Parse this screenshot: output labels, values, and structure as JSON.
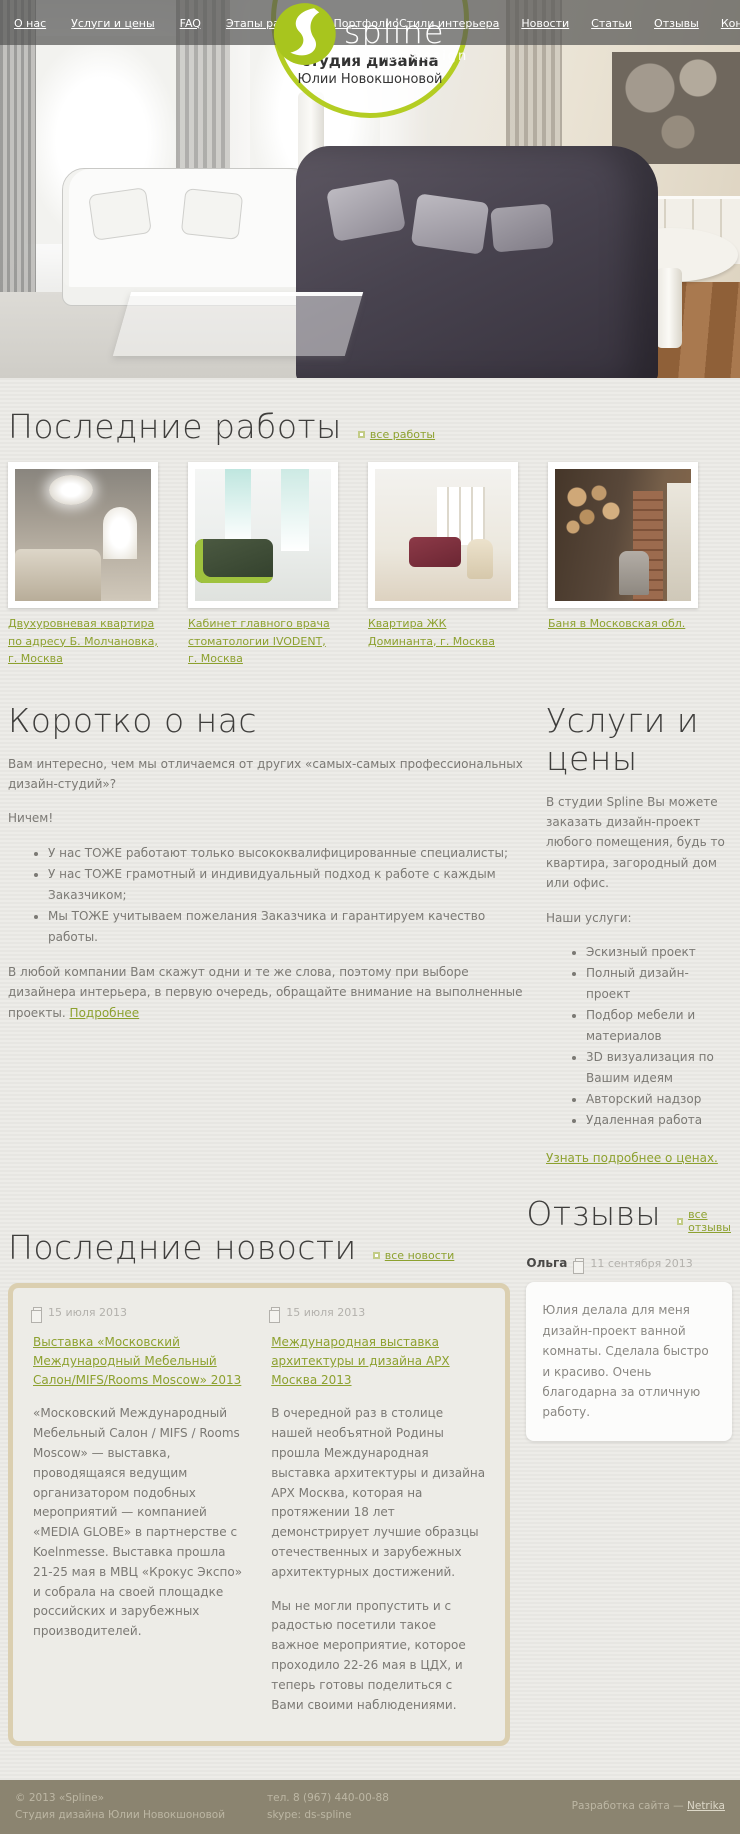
{
  "header": {
    "nav_left": [
      "О нас",
      "Услуги и цены",
      "FAQ",
      "Этапы работы",
      "Портфолио"
    ],
    "nav_right": [
      "Стили интерьера",
      "Новости",
      "Статьи",
      "Отзывы",
      "Контакты"
    ],
    "logo": {
      "name": "spline",
      "tagline": "interior design",
      "green": "#a8c51e"
    },
    "badge": {
      "line1": "студия дизайна",
      "line2": "Юлии Новокшоновой"
    }
  },
  "works": {
    "title": "Последние работы",
    "all_link": "все работы",
    "items": [
      {
        "title": "Двухуровневая квартира по адресу Б. Молчановка, г. Москва"
      },
      {
        "title": "Кабинет главного врача стоматологии IVODENT, г. Москва"
      },
      {
        "title": "Квартира ЖК Доминанта, г. Москва"
      },
      {
        "title": "Баня в Московская обл."
      }
    ]
  },
  "about": {
    "title": "Коротко о нас",
    "intro": "Вам интересно, чем мы отличаемся от других «самых-самых профессиональных дизайн-студий»?",
    "nothing": "Ничем!",
    "bullets": [
      "У нас ТОЖЕ работают только высококвалифицированные специалисты;",
      "У нас ТОЖЕ грамотный и индивидуальный подход к работе с каждым Заказчиком;",
      "Мы ТОЖЕ учитываем пожелания Заказчика и гарантируем качество работы."
    ],
    "outro": "В любой компании Вам скажут одни и те же слова, поэтому при выборе дизайнера интерьера, в первую очередь, обращайте внимание на выполненные проекты.",
    "more_link": "Подробнее"
  },
  "services": {
    "title": "Услуги и цены",
    "intro": "В студии Spline Вы можете заказать дизайн-проект любого помещения, будь то квартира, загородный дом или офис.",
    "list_label": "Наши услуги:",
    "items": [
      "Эскизный проект",
      "Полный дизайн-проект",
      "Подбор мебели и материалов",
      "3D визуализация по Вашим идеям",
      "Авторский надзор",
      "Удаленная работа"
    ],
    "prices_link": "Узнать подробнее о ценах."
  },
  "news": {
    "title": "Последние новости",
    "all_link": "все новости",
    "items": [
      {
        "date": "15 июля 2013",
        "title": "Выставка «Московский Международный Мебельный Салон/MIFS/Rooms Moscow» 2013",
        "paragraphs": [
          "«Московский Международный Мебельный Салон / MIFS / Rooms Moscow» — выставка, проводящаяся ведущим организатором подобных мероприятий — компанией «MEDIA GLOBE» в партнерстве с Koelnmesse. Выставка прошла 21-25 мая в МВЦ «Крокус Экспо» и собрала на своей площадке российских и зарубежных производителей."
        ]
      },
      {
        "date": "15 июля 2013",
        "title": "Международная выставка архитектуры и дизайна АРХ Москва 2013",
        "paragraphs": [
          "В очередной раз в столице нашей необъятной Родины прошла Международная выставка архитектуры и дизайна АРХ Москва, которая на протяжении 18 лет демонстрирует лучшие образцы отечественных и зарубежных архитектурных достижений.",
          "Мы не могли пропустить и с радостью посетили такое важное мероприятие, которое проходило 22-26 мая в ЦДХ, и теперь готовы поделиться с Вами своими наблюдениями."
        ]
      }
    ]
  },
  "reviews": {
    "title": "Отзывы",
    "all_link": "все отзывы",
    "items": [
      {
        "author": "Ольга",
        "date": "11 сентября 2013",
        "text": "Юлия делала для меня дизайн-проект ванной комнаты. Сделала быстро и красиво. Очень благодарна за отличную работу."
      }
    ]
  },
  "footer": {
    "copyright": "© 2013 «Spline»",
    "studio": "Студия дизайна Юлии Новокшоновой",
    "phone": "тел. 8 (967) 440-00-88",
    "skype": "skype: ds-spline",
    "credit_prefix": "Разработка сайта — ",
    "credit_link": "Netrika"
  },
  "colors": {
    "accent_green": "#8da12f",
    "logo_green": "#a8c51e",
    "footer_bg": "#8b8470",
    "news_border": "#dbcfb0"
  }
}
